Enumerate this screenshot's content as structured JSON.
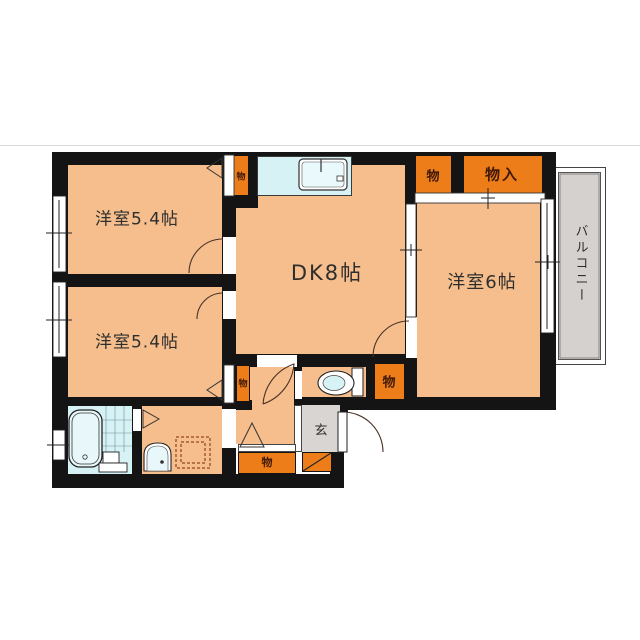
{
  "floor_plan": {
    "type": "japanese-apartment-floorplan",
    "rooms": [
      {
        "name": "western-room-1",
        "label": "洋室5.4帖"
      },
      {
        "name": "western-room-2",
        "label": "洋室5.4帖"
      },
      {
        "name": "dining-kitchen",
        "label": "DK8帖"
      },
      {
        "name": "western-room-3",
        "label": "洋室6帖"
      }
    ],
    "labels": {
      "closet": "物",
      "closet_large": "物入",
      "entrance": "玄",
      "balcony": "バルコニー"
    },
    "fixtures": [
      "bathtub",
      "kitchen-sink",
      "toilet",
      "washbasin",
      "washer-pan"
    ],
    "colors": {
      "floor": "#F5BE8C",
      "closet": "#ED7D18",
      "water": "#D6F2F5",
      "entrance_floor": "#D8D5D2",
      "balcony_floor": "#D5D1CE",
      "wall": "#141414"
    }
  }
}
